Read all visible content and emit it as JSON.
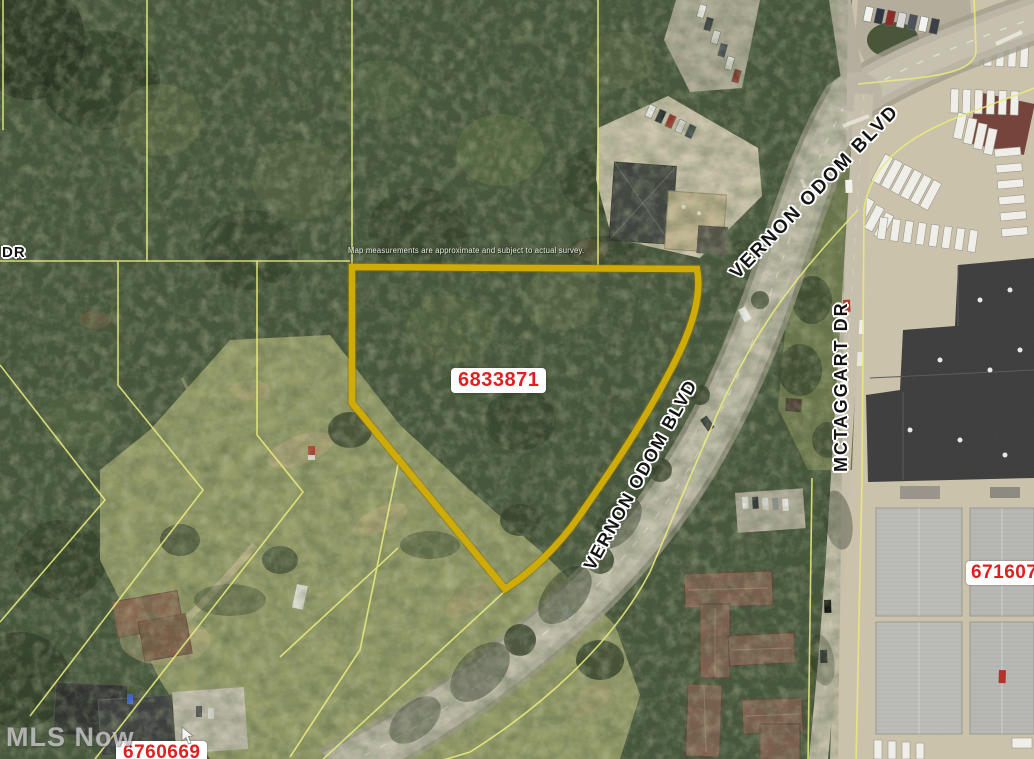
{
  "map": {
    "disclaimer": "Map measurements are approximate and subject to actual survey.",
    "watermark": "MLS Now",
    "subject_parcel_id": "6833871",
    "parcel_labels": [
      {
        "id": "6833871"
      },
      {
        "id": "671607"
      },
      {
        "id": "6760669"
      }
    ],
    "street_labels": [
      {
        "text": "VERNON ODOM BLVD"
      },
      {
        "text": "VERNON ODOM BLVD"
      },
      {
        "text": "MCTAGGART DR"
      },
      {
        "text": "DR"
      }
    ],
    "colors": {
      "subject_outline": "#cfab07",
      "parcel_lines": "#e9ec7d",
      "parcel_id_text": "#e02020",
      "parcel_id_bg": "#ffffff",
      "street_label_text": "#141414",
      "street_label_halo": "#ffffff"
    }
  }
}
